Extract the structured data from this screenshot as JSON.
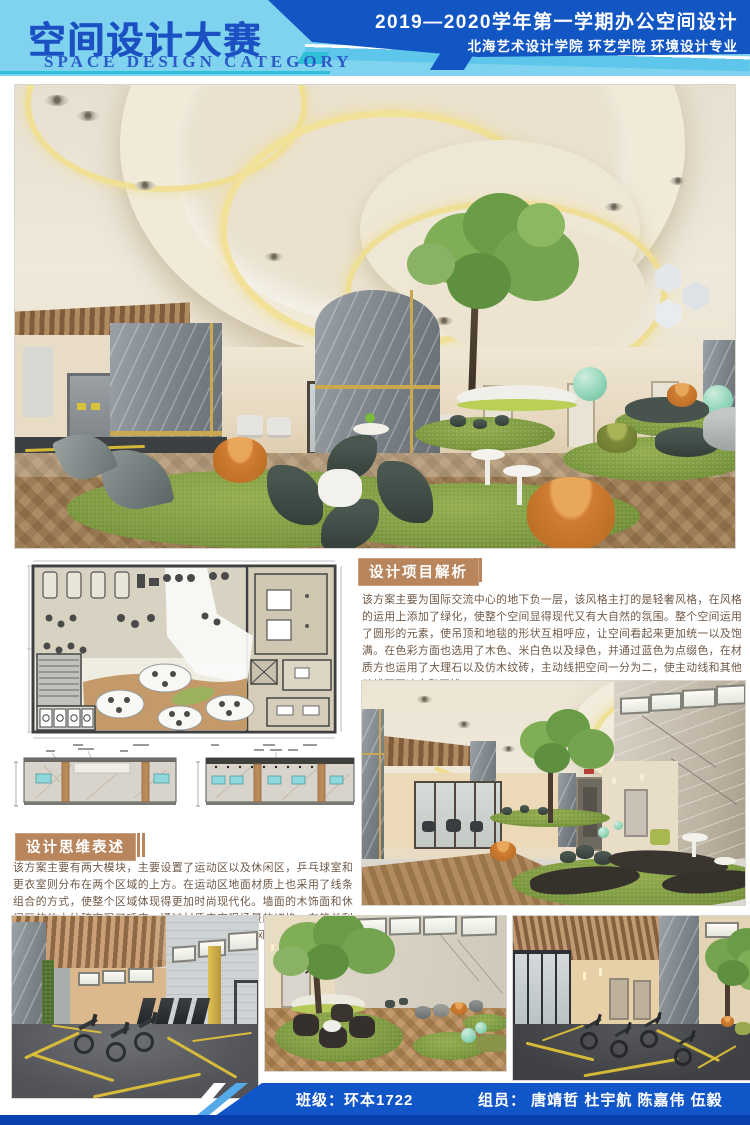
{
  "header": {
    "title_cn": "空间设计大赛",
    "title_en": "SPACE DESIGN CATEGORY",
    "course_line": "2019—2020学年第一学期办公空间设计",
    "dept_line": "北海艺术设计学院  环艺学院  环境设计专业"
  },
  "analysis": {
    "heading": "设计项目解析",
    "body": "该方案主要为国际交流中心的地下负一层，该风格主打的是轻奢风格，在风格的运用上添加了绿化，使整个空间显得现代又有大自然的氛围。整个空间运用了圆形的元素，使吊顶和地毯的形状互相呼应，让空间看起来更加统一以及饱满。在色彩方面也选用了木色、米白色以及绿色，并通过蓝色为点缀色，在材质方也运用了大理石以及仿木纹砖，主动线把空间一分为二，使主动线和其他动线互不冲突和干扰。"
  },
  "thinking": {
    "heading": "设计思维表述",
    "body": "该方案主要有两大模块，主要设置了运动区以及休闲区，乒乓球室和更衣室则分布在两个区域的上方。在运动区地面材质上也采用了线条组合的方式，使整个区域体现得更加时尚现代化。墙面的木饰面和休闲区的仿木纹砖实现了呼应，通过材质来实现场景的切换。在简单利落的空间格局中，各场域紧密地串联合一，使整个风格统一干练。"
  },
  "footer": {
    "class_line": "班级：环本1722",
    "team_line": "组员：  唐靖哲  杜宇航  陈嘉伟  伍毅"
  },
  "colors": {
    "header_light_blue": "#7fd3ee",
    "header_royal_blue": "#1256c4",
    "teal_accent": "#2fc0d8",
    "section_heading_tan": "#b9855c",
    "footer_blue": "#1156c8",
    "footer_navy": "#0a3fae",
    "carpet_green": "#7d9a40",
    "pouf_orange": "#cf7d33",
    "gold_trim": "#c9a851"
  }
}
